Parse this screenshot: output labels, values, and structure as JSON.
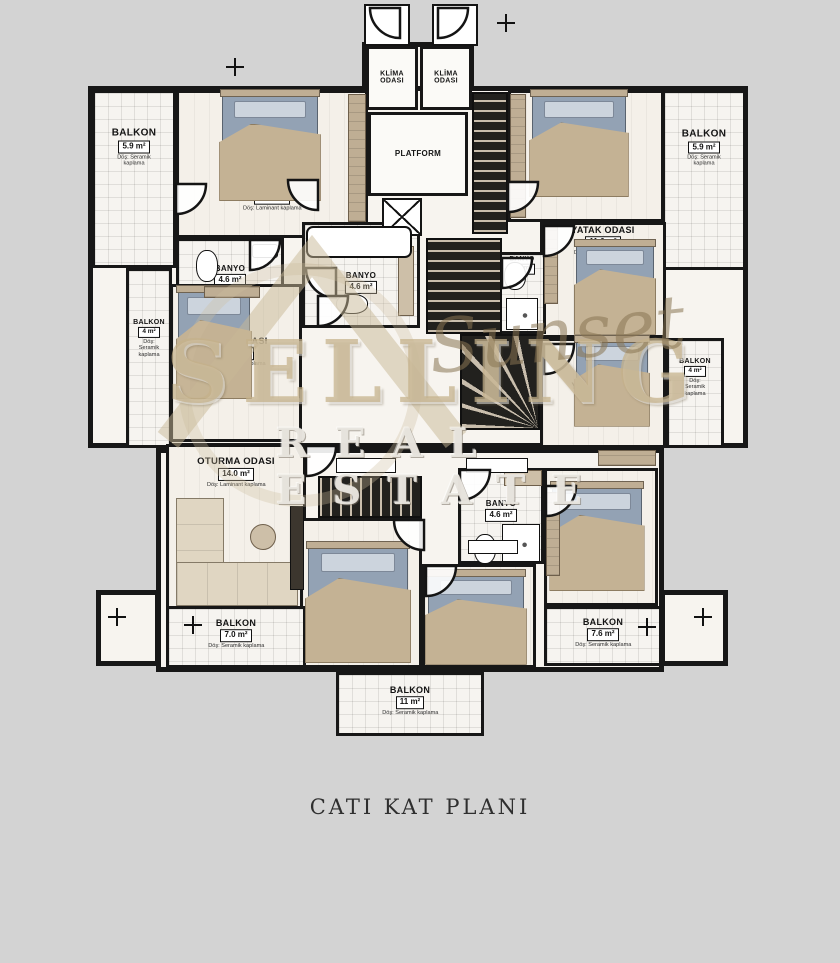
{
  "caption": "CATI KAT PLANI",
  "watermark": {
    "line1": "SELLING",
    "script": "Sunset",
    "line2": "REAL ESTATE"
  },
  "colors": {
    "page_bg": "#d3d3d3",
    "wall": "#171717",
    "floor": "#f7f4ef",
    "wood_accent": "#bfae94",
    "bed_mattress": "#93a2b4",
    "bed_blanket": "#c4b294",
    "stair_dark": "#22211e",
    "stair_tread": "#c9bead",
    "watermark_tan": "#c5b28a",
    "caption": "#2f2f2f"
  },
  "plan": {
    "footprint": [
      {
        "x": 362,
        "y": 42,
        "w": 112,
        "h": 70
      },
      {
        "x": 88,
        "y": 86,
        "w": 660,
        "h": 362
      },
      {
        "x": 156,
        "y": 448,
        "w": 508,
        "h": 224
      },
      {
        "x": 336,
        "y": 672,
        "w": 148,
        "h": 64
      },
      {
        "x": 96,
        "y": 590,
        "w": 64,
        "h": 76
      },
      {
        "x": 660,
        "y": 590,
        "w": 68,
        "h": 76
      }
    ],
    "rooms": [
      {
        "id": "balkon-top-left",
        "label": "BALKON",
        "area": "5.9 m²",
        "note": "Döş: Seramik kaplama",
        "x": 92,
        "y": 90,
        "w": 84,
        "h": 178,
        "floor": "tile",
        "ly": 0.34
      },
      {
        "id": "yatak-odasi-top-left",
        "label": "YATAK ODASI",
        "area": "15.9 m²",
        "note": "Döş: Laminant kaplama",
        "x": 176,
        "y": 90,
        "w": 192,
        "h": 148,
        "floor": "wood",
        "ly": 0.74
      },
      {
        "id": "banyo-left",
        "label": "BANYO",
        "area": "4.6 m²",
        "x": 176,
        "y": 238,
        "w": 108,
        "h": 76,
        "floor": "tile",
        "ly": 0.5,
        "fs": 8
      },
      {
        "id": "banyo-center",
        "label": "BANYO",
        "area": "4.6 m²",
        "x": 302,
        "y": 222,
        "w": 118,
        "h": 106,
        "floor": "tile",
        "ly": 0.58,
        "fs": 8
      },
      {
        "id": "yatak-odasi-mid-left",
        "label": "YATAK ODASI",
        "area": "11.6 m²",
        "note": "Döş: Laminant kaplama",
        "x": 170,
        "y": 284,
        "w": 132,
        "h": 158,
        "floor": "wood",
        "ly": 0.44,
        "fs": 9
      },
      {
        "id": "balkon-mid-left",
        "label": "BALKON",
        "area": "4 m²",
        "note": "Döş: Seramik kaplama",
        "x": 126,
        "y": 268,
        "w": 46,
        "h": 180,
        "floor": "tile",
        "ly": 0.42,
        "fs": 7
      },
      {
        "id": "klima-odasi-1",
        "label": "KLİMA\nODASI",
        "x": 366,
        "y": 46,
        "w": 52,
        "h": 64,
        "floor": "plain",
        "ly": 0.5,
        "fs": 7
      },
      {
        "id": "klima-odasi-2",
        "label": "KLİMA\nODASI",
        "x": 420,
        "y": 46,
        "w": 52,
        "h": 64,
        "floor": "plain",
        "ly": 0.5,
        "fs": 7
      },
      {
        "id": "platform",
        "label": "PLATFORM",
        "x": 368,
        "y": 112,
        "w": 100,
        "h": 84,
        "floor": "plain",
        "ly": 0.5,
        "fs": 8
      },
      {
        "id": "yatak-odasi-top-right",
        "label": "YATAK ODASI",
        "area": "15.9 m²",
        "note": "Döş: Laminant kaplama",
        "x": 508,
        "y": 90,
        "w": 156,
        "h": 132,
        "floor": "wood",
        "ly": 0.72
      },
      {
        "id": "balkon-top-right",
        "label": "BALKON",
        "area": "5.9 m²",
        "note": "Döş: Seramik kaplama",
        "x": 662,
        "y": 90,
        "w": 84,
        "h": 180,
        "floor": "tile",
        "ly": 0.34
      },
      {
        "id": "yatak-odasi-right-2",
        "label": "YATAK ODASI",
        "area": "11.6 m²",
        "note": "Döş: Laminant kaplama",
        "x": 540,
        "y": 222,
        "w": 126,
        "h": 116,
        "floor": "wood",
        "ly": 0.16,
        "fs": 9
      },
      {
        "id": "yatak-odasi-right-3",
        "label": "YATAK ODASI",
        "area": "11.6 m²",
        "note": "Döş: Laminant kaplama",
        "x": 540,
        "y": 338,
        "w": 126,
        "h": 110,
        "floor": "wood",
        "ly": 0.56,
        "fs": 9
      },
      {
        "id": "balkon-mid-right",
        "label": "BALKON",
        "area": "4 m²",
        "note": "Döş: Seramik kaplama",
        "x": 666,
        "y": 338,
        "w": 58,
        "h": 110,
        "floor": "tile",
        "ly": 0.4,
        "fs": 7
      },
      {
        "id": "banyo-right",
        "label": "BANYO",
        "area": "4.6 m²",
        "x": 498,
        "y": 252,
        "w": 48,
        "h": 82,
        "floor": "tile",
        "ly": 0.14,
        "fs": 6.5
      },
      {
        "id": "oturma-odasi",
        "label": "OTURMA ODASI",
        "area": "14.0 m²",
        "note": "Döş: Laminant kaplama",
        "x": 166,
        "y": 444,
        "w": 140,
        "h": 166,
        "floor": "wood",
        "ly": 0.17,
        "fs": 9.5
      },
      {
        "id": "banyo-bottom",
        "label": "BANYO",
        "area": "4.6 m²",
        "x": 458,
        "y": 468,
        "w": 86,
        "h": 96,
        "floor": "tile",
        "ly": 0.44,
        "fs": 8
      },
      {
        "id": "yatak-odasi-bottom-1",
        "label": "YATAK ODASI",
        "area": "14 m²",
        "note": "Döş: Laminant kaplama",
        "x": 300,
        "y": 518,
        "w": 122,
        "h": 150,
        "floor": "wood",
        "ly": 0.76,
        "fs": 9
      },
      {
        "id": "yatak-odasi-bottom-2",
        "label": "YATAK ODASI",
        "area": "10.8 m²",
        "note": "Döş: Laminant kaplama",
        "x": 422,
        "y": 564,
        "w": 114,
        "h": 104,
        "floor": "wood",
        "ly": 0.72,
        "fs": 8.5
      },
      {
        "id": "yatak-odasi-bottom-right",
        "label": "YATAK ODASI",
        "area": "10.8 m²",
        "note": "Döş: Laminant kaplama",
        "x": 544,
        "y": 468,
        "w": 114,
        "h": 138,
        "floor": "wood",
        "ly": 0.8,
        "fs": 9
      },
      {
        "id": "balkon-bottom-left",
        "label": "BALKON",
        "area": "7.0 m²",
        "note": "Döş: Seramik kaplama",
        "x": 166,
        "y": 606,
        "w": 140,
        "h": 62,
        "floor": "tile",
        "ly": 0.48,
        "fs": 9
      },
      {
        "id": "balkon-bottom-right",
        "label": "BALKON",
        "area": "7.6 m²",
        "note": "Döş: Seramik kaplama",
        "x": 544,
        "y": 606,
        "w": 118,
        "h": 60,
        "floor": "tile",
        "ly": 0.48,
        "fs": 9
      },
      {
        "id": "balkon-bottom-center",
        "label": "BALKON",
        "area": "11 m²",
        "note": "Döş: Seramik kaplama",
        "x": 336,
        "y": 672,
        "w": 148,
        "h": 64,
        "floor": "tile",
        "ly": 0.48,
        "fs": 9
      }
    ],
    "beds": [
      {
        "x": 222,
        "y": 96,
        "w": 96,
        "h": 104
      },
      {
        "x": 532,
        "y": 96,
        "w": 94,
        "h": 100
      },
      {
        "x": 178,
        "y": 292,
        "w": 72,
        "h": 106
      },
      {
        "x": 576,
        "y": 246,
        "w": 78,
        "h": 88
      },
      {
        "x": 576,
        "y": 342,
        "w": 72,
        "h": 84
      },
      {
        "x": 308,
        "y": 548,
        "w": 100,
        "h": 114
      },
      {
        "x": 428,
        "y": 576,
        "w": 96,
        "h": 88
      },
      {
        "x": 552,
        "y": 488,
        "w": 90,
        "h": 102
      }
    ],
    "stairs": [
      {
        "x": 472,
        "y": 92,
        "w": 36,
        "h": 142,
        "kind": "v"
      },
      {
        "x": 426,
        "y": 238,
        "w": 76,
        "h": 96,
        "kind": "v"
      },
      {
        "x": 460,
        "y": 334,
        "w": 80,
        "h": 96,
        "kind": "spiral"
      },
      {
        "x": 318,
        "y": 476,
        "w": 104,
        "h": 42,
        "kind": "h"
      }
    ],
    "doors": [
      {
        "x": 370,
        "y": 8,
        "rot": 90
      },
      {
        "x": 438,
        "y": 8,
        "rot": 0
      },
      {
        "x": 176,
        "y": 184,
        "rot": 0
      },
      {
        "x": 288,
        "y": 180,
        "rot": 90
      },
      {
        "x": 250,
        "y": 240,
        "rot": 0
      },
      {
        "x": 306,
        "y": 268,
        "rot": 90
      },
      {
        "x": 318,
        "y": 296,
        "rot": 0
      },
      {
        "x": 508,
        "y": 182,
        "rot": 0
      },
      {
        "x": 544,
        "y": 226,
        "rot": 0
      },
      {
        "x": 544,
        "y": 344,
        "rot": 0
      },
      {
        "x": 502,
        "y": 258,
        "rot": 0
      },
      {
        "x": 306,
        "y": 446,
        "rot": 0
      },
      {
        "x": 460,
        "y": 470,
        "rot": 0
      },
      {
        "x": 394,
        "y": 520,
        "rot": 90
      },
      {
        "x": 426,
        "y": 566,
        "rot": 0
      },
      {
        "x": 546,
        "y": 486,
        "rot": 0
      }
    ],
    "fixtures": [
      {
        "t": "doorbox",
        "x": 364,
        "y": 4,
        "w": 46,
        "h": 42
      },
      {
        "t": "doorbox",
        "x": 432,
        "y": 4,
        "w": 46,
        "h": 42
      },
      {
        "t": "shaft",
        "x": 382,
        "y": 198,
        "w": 40,
        "h": 38
      },
      {
        "t": "wardrobe",
        "x": 348,
        "y": 94,
        "w": 18,
        "h": 128
      },
      {
        "t": "wardrobe",
        "x": 510,
        "y": 94,
        "w": 16,
        "h": 124
      },
      {
        "t": "wardrobe",
        "x": 544,
        "y": 226,
        "w": 14,
        "h": 78
      },
      {
        "t": "wardrobe",
        "x": 546,
        "y": 492,
        "w": 14,
        "h": 84
      },
      {
        "t": "wardrobe",
        "x": 598,
        "y": 450,
        "w": 58,
        "h": 16
      },
      {
        "t": "wardrobe",
        "x": 204,
        "y": 286,
        "w": 56,
        "h": 12
      },
      {
        "t": "counter",
        "x": 398,
        "y": 246,
        "w": 16,
        "h": 70
      },
      {
        "t": "counter",
        "x": 504,
        "y": 470,
        "w": 38,
        "h": 16
      },
      {
        "t": "sink",
        "x": 252,
        "y": 244,
        "w": 26,
        "h": 14
      },
      {
        "t": "tub",
        "x": 306,
        "y": 226,
        "w": 106,
        "h": 32
      },
      {
        "t": "toilet",
        "x": 196,
        "y": 250,
        "w": 22,
        "h": 32
      },
      {
        "t": "toilet",
        "x": 336,
        "y": 294,
        "w": 32,
        "h": 20
      },
      {
        "t": "toilet",
        "x": 474,
        "y": 534,
        "w": 22,
        "h": 30
      },
      {
        "t": "toilet",
        "x": 504,
        "y": 262,
        "w": 22,
        "h": 28
      },
      {
        "t": "shower",
        "x": 502,
        "y": 524,
        "w": 38,
        "h": 38
      },
      {
        "t": "shower",
        "x": 506,
        "y": 298,
        "w": 32,
        "h": 32
      },
      {
        "t": "tv",
        "x": 290,
        "y": 506,
        "w": 14,
        "h": 84
      },
      {
        "t": "table",
        "x": 250,
        "y": 524,
        "w": 26,
        "h": 26
      },
      {
        "t": "tag",
        "x": 336,
        "y": 458,
        "w": 60,
        "h": 15
      },
      {
        "t": "tag",
        "x": 466,
        "y": 458,
        "w": 62,
        "h": 15
      },
      {
        "t": "tag",
        "x": 468,
        "y": 540,
        "w": 50,
        "h": 14
      }
    ],
    "sofa": [
      {
        "x": 176,
        "y": 498,
        "w": 48,
        "h": 106,
        "o": "v"
      },
      {
        "x": 176,
        "y": 562,
        "w": 122,
        "h": 44,
        "o": "h"
      }
    ],
    "dims": [
      {
        "x": 226,
        "y": 58
      },
      {
        "x": 497,
        "y": 14
      },
      {
        "x": 108,
        "y": 608
      },
      {
        "x": 694,
        "y": 608
      },
      {
        "x": 638,
        "y": 618
      },
      {
        "x": 184,
        "y": 616
      }
    ]
  }
}
